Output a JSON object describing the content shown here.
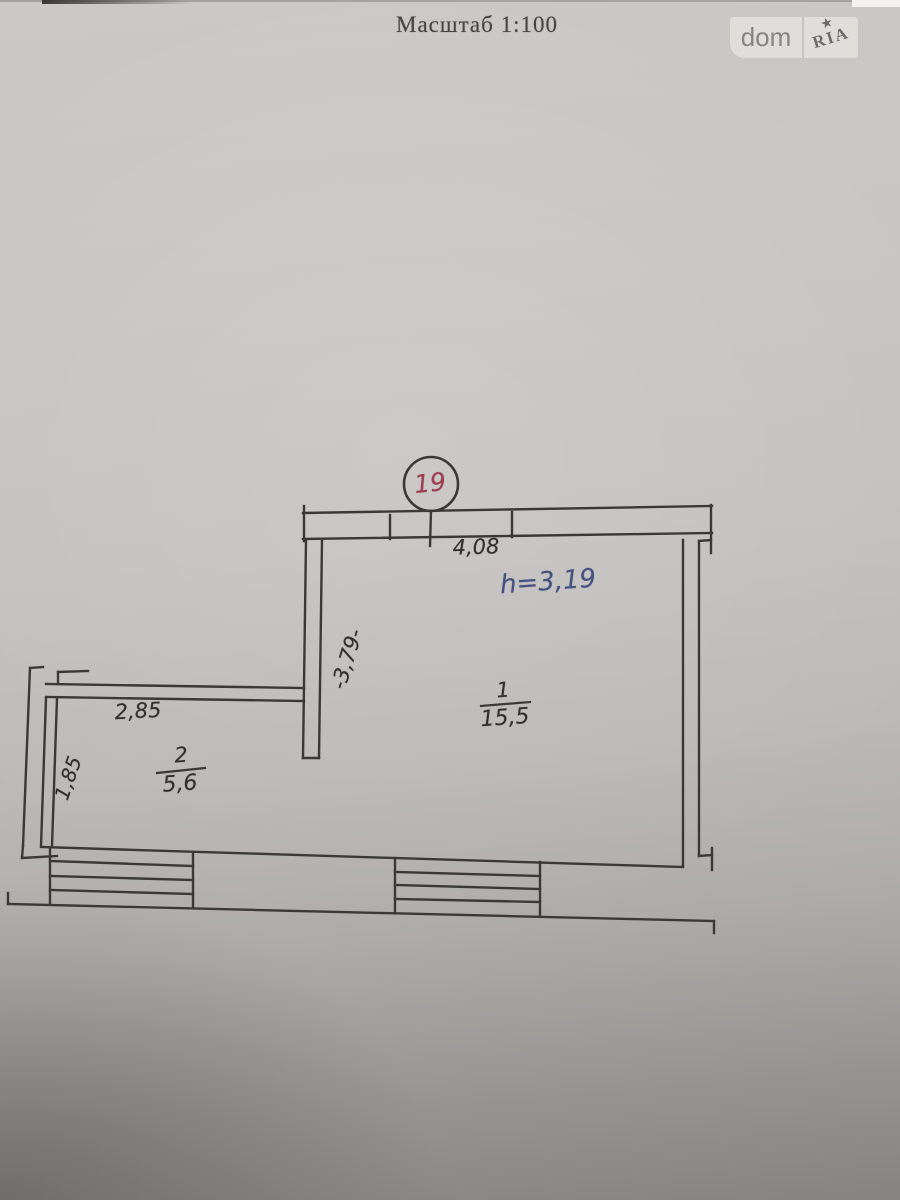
{
  "photo": {
    "scale_label": "Масштаб 1:100"
  },
  "watermark": {
    "dom": "dom",
    "ria": "RIA",
    "star": "★"
  },
  "plan": {
    "entrance_circle_number": "19",
    "height_note": "h=3,19",
    "dimensions": {
      "room1_width": "4,08",
      "room1_depth": "-3,79-",
      "room2_width": "2,85",
      "room2_depth": "1,85"
    },
    "rooms": [
      {
        "number": "1",
        "area": "15,5"
      },
      {
        "number": "2",
        "area": "5,6"
      }
    ]
  },
  "colors": {
    "ink": "#3b3937",
    "circle_number_red": "#9c3d52",
    "height_note_blue": "#46517e",
    "paper_gray": "#c4c2c0"
  }
}
